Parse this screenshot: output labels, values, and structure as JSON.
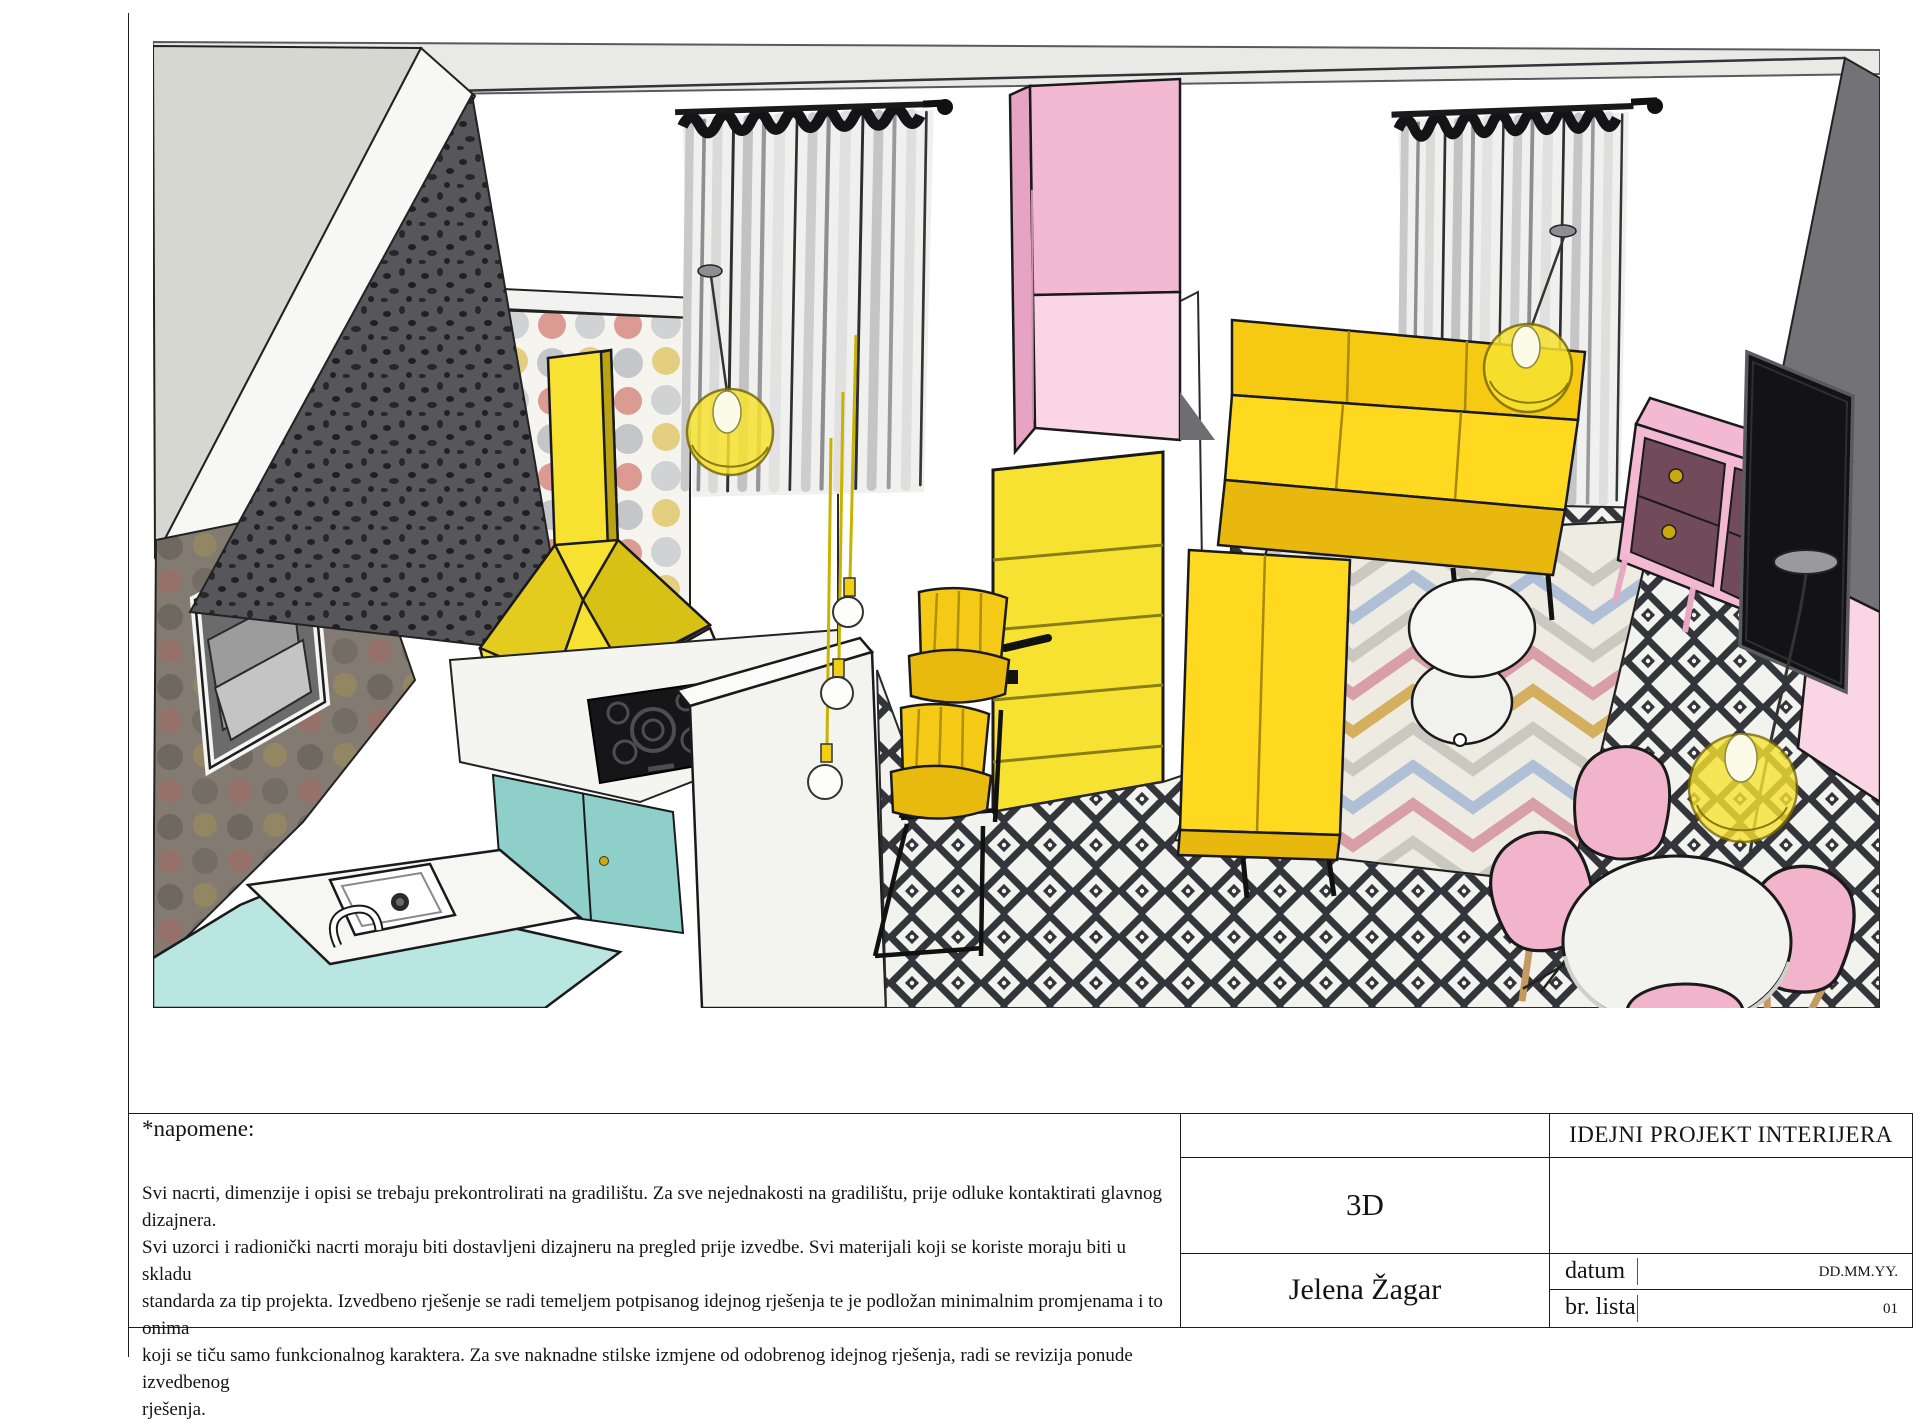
{
  "titleblock": {
    "notes_label": "*napomene:",
    "notes_lines": [
      "Svi nacrti, dimenzije i opisi se trebaju prekontrolirati na gradilištu. Za sve nejednakosti na gradilištu, prije odluke kontaktirati glavnog dizajnera.",
      "Svi uzorci i radionički nacrti moraju biti dostavljeni dizajneru na pregled prije izvedbe. Svi materijali koji se koriste moraju biti u skladu",
      "standarda za tip projekta. Izvedbeno rješenje se radi temeljem potpisanog idejnog rješenja te je podložan minimalnim promjenama i to onima",
      "koji se tiču samo funkcionalnog karaktera. Za sve naknadne stilske izmjene od odobrenog idejnog rješenja, radi se revizija ponude izvedbenog",
      "rješenja."
    ],
    "view_label": "3D",
    "author": "Jelena Žagar",
    "project_title": "IDEJNI PROJEKT INTERIJERA",
    "date_label": "datum",
    "date_value": "DD.MM.YY.",
    "sheet_label": "br. lista",
    "sheet_value": "01"
  },
  "palette": {
    "yellow": "#f2cf15",
    "yellow-bright": "#f7e231",
    "yellow-dark": "#c9a90e",
    "pink": "#f4b9d2",
    "pink-light": "#fad6e5",
    "plum": "#714b59",
    "teal": "#a7ddd9",
    "teal-light": "#b9e6e1",
    "teal-dark": "#8fcfca",
    "floor-dark": "#34343b",
    "floor-light": "#f2f2ee",
    "wall-gray": "#737377",
    "ceiling": "#e9e9e5",
    "rug-cream": "#edebe2",
    "wood": "#c49a63"
  },
  "scene": {
    "description": "3D SketchUp-style render of an open-plan kitchen, hallway and living room",
    "elements": [
      "polka-dot wallpaper",
      "speckled accent wall",
      "pass-through window",
      "yellow cooker hood",
      "induction cooktop",
      "teal kitchen cabinets",
      "kitchen sink",
      "white breakfast bar",
      "pendant bulbs",
      "yellow bar stools",
      "yellow interior door",
      "pink wardrobe",
      "sheer curtains",
      "yellow globe pendant lamps",
      "yellow corner sofa",
      "chevron rug",
      "white round coffee table",
      "black and white diamond tile floor",
      "pink tv sideboard",
      "flat screen tv",
      "yellow globe floor lamp",
      "white round dining table",
      "pink shell dining chairs"
    ]
  }
}
